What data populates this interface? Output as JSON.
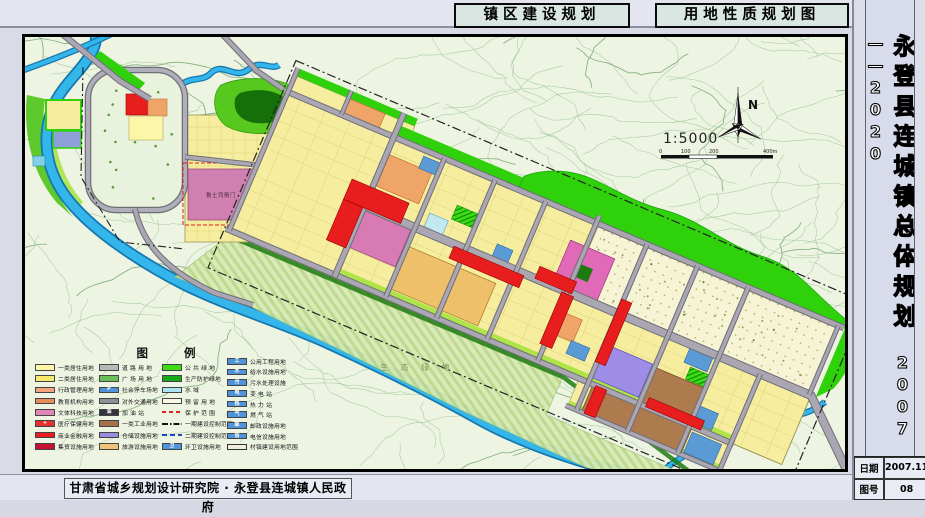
{
  "titles": {
    "box1": "镇区建设规划",
    "box2": "用地性质规划图"
  },
  "side": {
    "title": "永登县连城镇总体规划",
    "years": "2007——2020",
    "table": [
      {
        "label": "日期",
        "value": "2007.11"
      },
      {
        "label": "图号",
        "value": "08"
      }
    ]
  },
  "footer": {
    "credit": "甘肃省城乡规划设计研究院 · 永登县连城镇人民政府"
  },
  "map": {
    "north_label": "N",
    "scale_text": "1:5000",
    "scale_ticks": [
      "0",
      "100",
      "200",
      "400m"
    ],
    "labels": {
      "historic": "鲁土司衙门",
      "eco": "生 态 绿 地"
    },
    "colors": {
      "residential1": "#fdf6a8",
      "residential2": "#f6ee9e",
      "commercial": "#e81e1e",
      "education": "#f0a568",
      "culture": "#d87ab4",
      "industry": "#ad7b4e",
      "warehouse": "#9d8de6",
      "utility": "#5b9bd5",
      "green": "#2fd10a",
      "water": "#35b6ea",
      "road": "#a8a4ae",
      "market": "#eec06a"
    }
  },
  "legend": {
    "title": "图  例",
    "columns": [
      {
        "items": [
          {
            "label": "一类居住用地",
            "fill": "#fdf6a8"
          },
          {
            "label": "二类居住用地",
            "fill": "#f6ea6e"
          },
          {
            "label": "行政管理用地",
            "fill": "#f2a47e"
          },
          {
            "label": "教育机构用地",
            "fill": "#e98a5a"
          },
          {
            "label": "文体科技用地",
            "fill": "#e087b8"
          },
          {
            "label": "医疗保健用地",
            "fill": "#e63030",
            "glyph": "+"
          },
          {
            "label": "商业金融用地",
            "fill": "#e81e1e"
          },
          {
            "label": "集贸设施用地",
            "fill": "#c41230"
          }
        ]
      },
      {
        "items": [
          {
            "label": "道 路 用 地",
            "fill": "#b8b8b8"
          },
          {
            "label": "广 场 用 地",
            "fill": "#6abf5a",
            "kind": "hatch"
          },
          {
            "label": "社会停车场地",
            "fill": "#4f93d8",
            "glyph": "P"
          },
          {
            "label": "对外交通用地",
            "fill": "#8f8f97"
          },
          {
            "label": "加 油 站",
            "fill": "#33333e",
            "glyph": "油"
          },
          {
            "label": "一类工业用地",
            "fill": "#a5714a"
          },
          {
            "label": "仓储设施用地",
            "fill": "#9a8ae0"
          },
          {
            "label": "旅游设施用地",
            "fill": "#eec27c"
          }
        ]
      },
      {
        "items": [
          {
            "label": "公 共 绿 地",
            "fill": "#3ddc14"
          },
          {
            "label": "生产防护绿地",
            "fill": "#17a817"
          },
          {
            "label": "水    域",
            "fill": "#aee4f2"
          },
          {
            "label": "预 留 用 地",
            "fill": "#faf8e4"
          },
          {
            "label": "保 护 范 围",
            "kind": "line",
            "line": "l-red"
          },
          {
            "label": "一期建设控制范围",
            "kind": "line",
            "line": "l-dd"
          },
          {
            "label": "二期建设控制范围",
            "kind": "line",
            "line": "l-blue"
          },
          {
            "label": "环卫设施用地",
            "fill": "#4f93d8",
            "glyph": "卫"
          }
        ]
      },
      {
        "items": [
          {
            "label": "公用工程用地",
            "fill": "#4f93d8",
            "glyph": "工"
          },
          {
            "label": "给水设施用地",
            "fill": "#4f93d8",
            "glyph": "水"
          },
          {
            "label": "污水处理设施",
            "fill": "#4f93d8",
            "glyph": "污"
          },
          {
            "label": "变 电 站",
            "fill": "#4f93d8",
            "glyph": "电"
          },
          {
            "label": "热 力 站",
            "fill": "#4f93d8",
            "glyph": "热"
          },
          {
            "label": "燃 气 站",
            "fill": "#4f93d8",
            "glyph": "气"
          },
          {
            "label": "邮政设施用地",
            "fill": "#4f93d8",
            "glyph": "邮"
          },
          {
            "label": "电信设施用地",
            "fill": "#4f93d8",
            "glyph": "信"
          },
          {
            "label": "村镇建设用地范围",
            "kind": "outline"
          }
        ]
      }
    ]
  }
}
